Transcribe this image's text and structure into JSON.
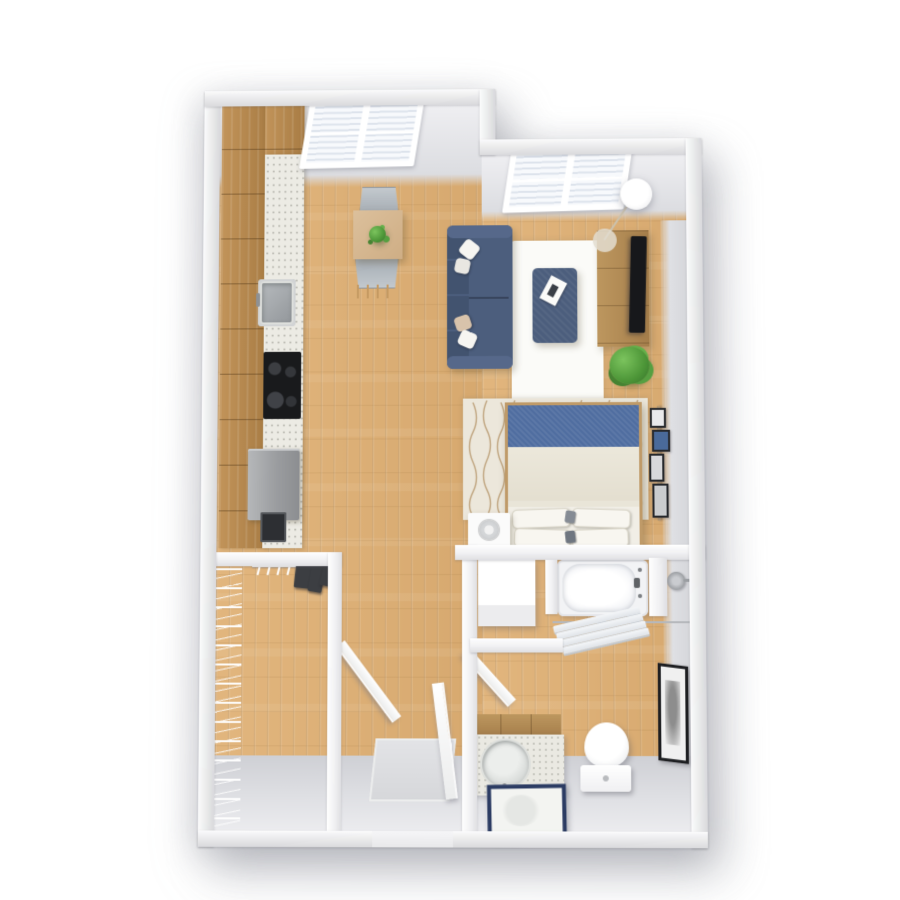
{
  "scene": {
    "type": "floor-plan-3d-render",
    "description": "Top-down 3D rendering of a studio apartment floor plan",
    "visible_text": ""
  },
  "palette": {
    "floor": "#dcb078",
    "cabinet-wood": "#b5894e",
    "counter": "#ecebe4",
    "wall-face": "#dcdde1",
    "wall-top": "#fbfbfc",
    "sofa": "#4c5e7d",
    "rug": "#fbfbf8",
    "stand-wood": "#b28b5a",
    "tv": "#17181b",
    "bed-blue": "#4f6da0",
    "bed-rug": "#ece7db",
    "mirror-frame": "#2c3c63",
    "cooktop": "#191a1c",
    "art-frame": "#1d1e21",
    "plant-green": "#4d9638",
    "shadow": "rgba(125,127,138,0.45)"
  },
  "items": {
    "kitchen_cabinets": "wood cabinet run",
    "kitchen_counter": "white speckled countertop",
    "kitchen_sink": "stainless steel sink with faucet",
    "cooktop": "black four-burner cooktop",
    "refrigerator": "stainless appliance",
    "window_kitchen": "double window with white blinds",
    "window_living": "double window with white blinds",
    "dining_table": "square wood dining table",
    "dining_chair_north": "gray dining chair",
    "dining_chair_south": "gray dining chair",
    "table_plant": "small potted plant",
    "sofa": "blue fabric sofa with throw pillows",
    "area_rug": "white area rug",
    "ottoman": "blue ottoman with serving tray",
    "tv_stand": "wood media console",
    "tv": "flat-screen television",
    "floor_lamp": "arc floor lamp",
    "floor_plant": "potted plant",
    "bed": "bed with blue headboard throw and white pillows",
    "bed_rug": "patterned bedroom rug",
    "nightstand": "white nightstand with round speaker",
    "gallery_frames": "wall-mounted picture ledge with frames",
    "dresser": "white dresser",
    "bathtub": "built-in bathtub with faucet",
    "shower_head": "wall shower head",
    "towel_rack": "towel rack with folded towels",
    "vanity": "bathroom vanity with round sink",
    "vanity_mirror": "navy-framed vanity mirror",
    "toilet": "toilet",
    "wall_art": "framed wall art",
    "closet_shelving": "wire closet shelving",
    "closet_rod": "closet rod with hangers and clothes",
    "closet_door": "open interior door",
    "bathroom_door": "open interior door",
    "entry_door": "open entry door",
    "door_mat": "entry door mat"
  }
}
